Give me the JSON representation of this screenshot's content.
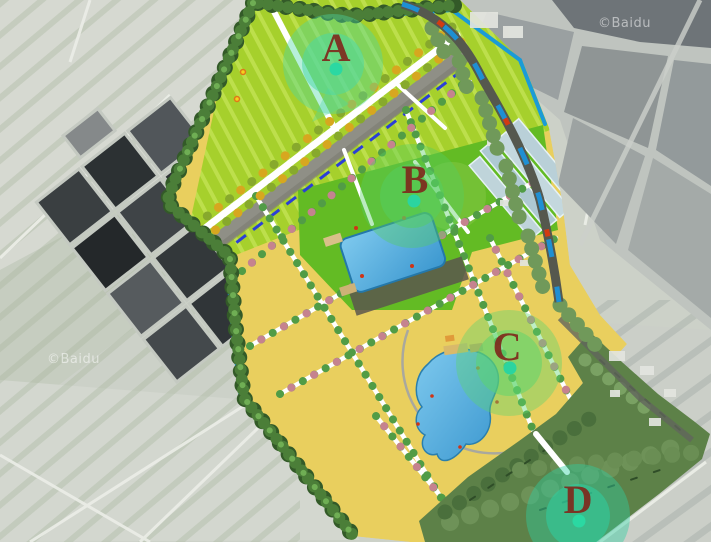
{
  "map": {
    "watermarks": [
      {
        "text": "©Baidu",
        "position": "top-right"
      },
      {
        "text": "©Baidu",
        "position": "bottom-left"
      }
    ],
    "markers": [
      {
        "id": "A",
        "label": "A",
        "x": 333,
        "y": 64,
        "glow_color": "#4ad8a4",
        "dot_color": "#2bd8a2"
      },
      {
        "id": "B",
        "label": "B",
        "x": 412,
        "y": 196,
        "glow_color": "#55cd62",
        "dot_color": "#2bd4a0"
      },
      {
        "id": "C",
        "label": "C",
        "x": 509,
        "y": 363,
        "glow_color": "#5cd46e",
        "dot_color": "#2bd4a0"
      },
      {
        "id": "D",
        "label": "D",
        "x": 578,
        "y": 516,
        "glow_color": "#2ed0a2",
        "dot_color": "#2bd8a2"
      }
    ],
    "letter_color": "#7f2a1d",
    "palette": {
      "field_yellow": "#e9cf5e",
      "field_lime": "#a6d02c",
      "field_green": "#63bb24",
      "water_blue": "#1b9bd7",
      "pond_blue": "#4aa8e0",
      "forest_green": "#5d8148",
      "tree_border": "#4b7e38",
      "road_dark": "#55584e",
      "dash_blue": "#2b3fd6",
      "car_red": "#d23b12",
      "path_white": "#ffffff"
    }
  }
}
